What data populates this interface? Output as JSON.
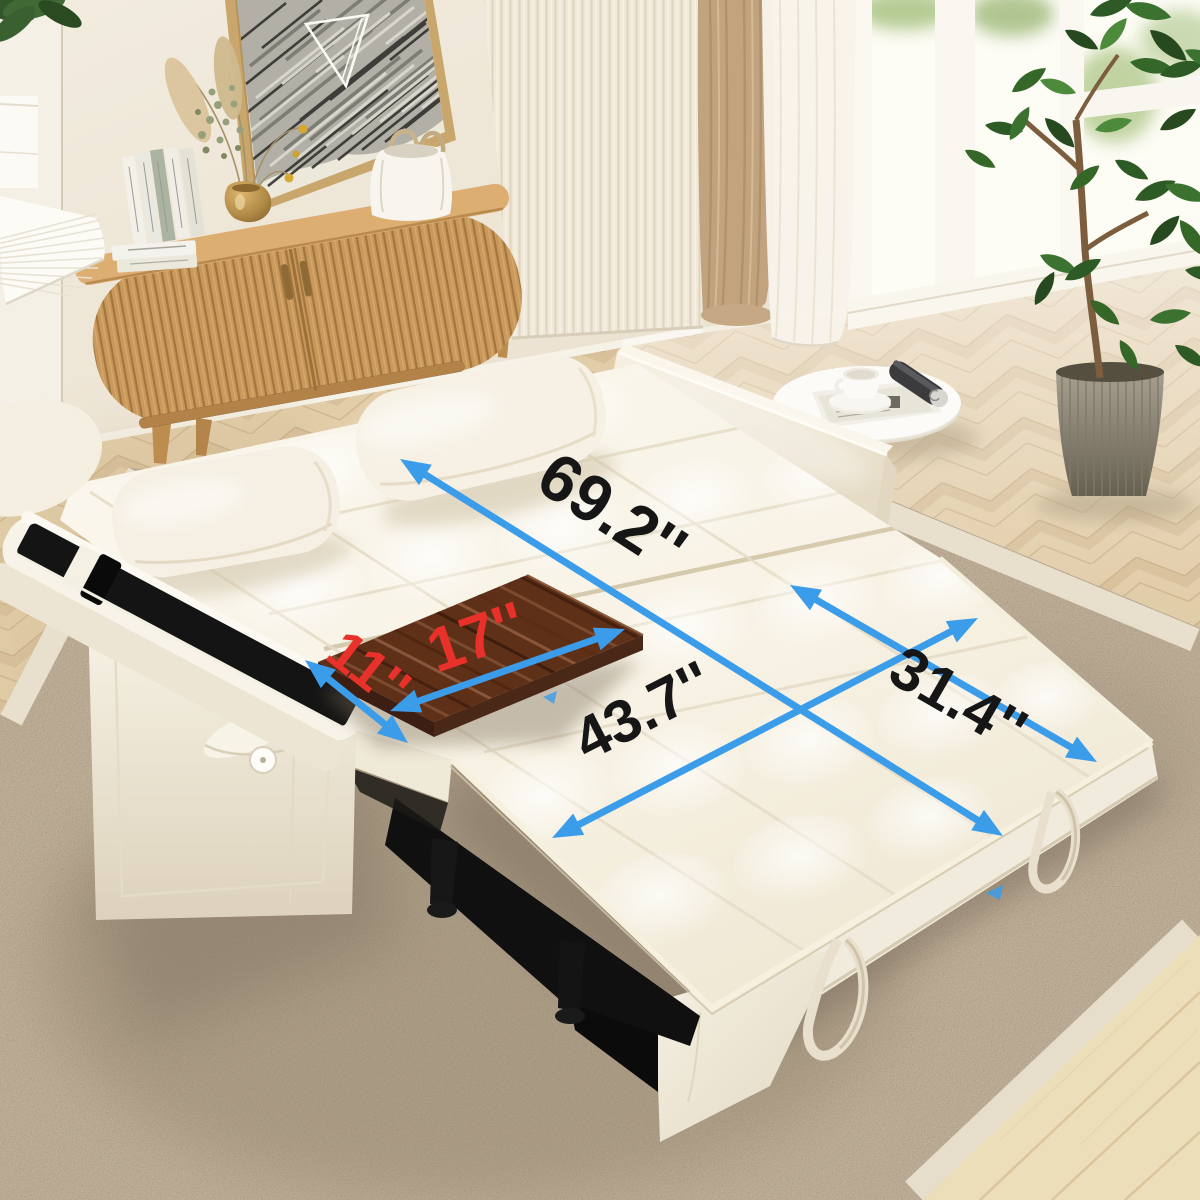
{
  "scene": {
    "description": "Cream velvet convertible sleeper sofa pulled out into a bed, shown in a bright living room with dimension annotations",
    "dimensions": {
      "bed_length": "69.2''",
      "bed_width": "43.7''",
      "seat_section": "31.4''",
      "tray_length": "17''",
      "tray_width": "11''"
    },
    "colors": {
      "arrow_blue": "#3b9ce9",
      "dimension_text": "#161616",
      "tray_text": "#e8312a"
    }
  }
}
